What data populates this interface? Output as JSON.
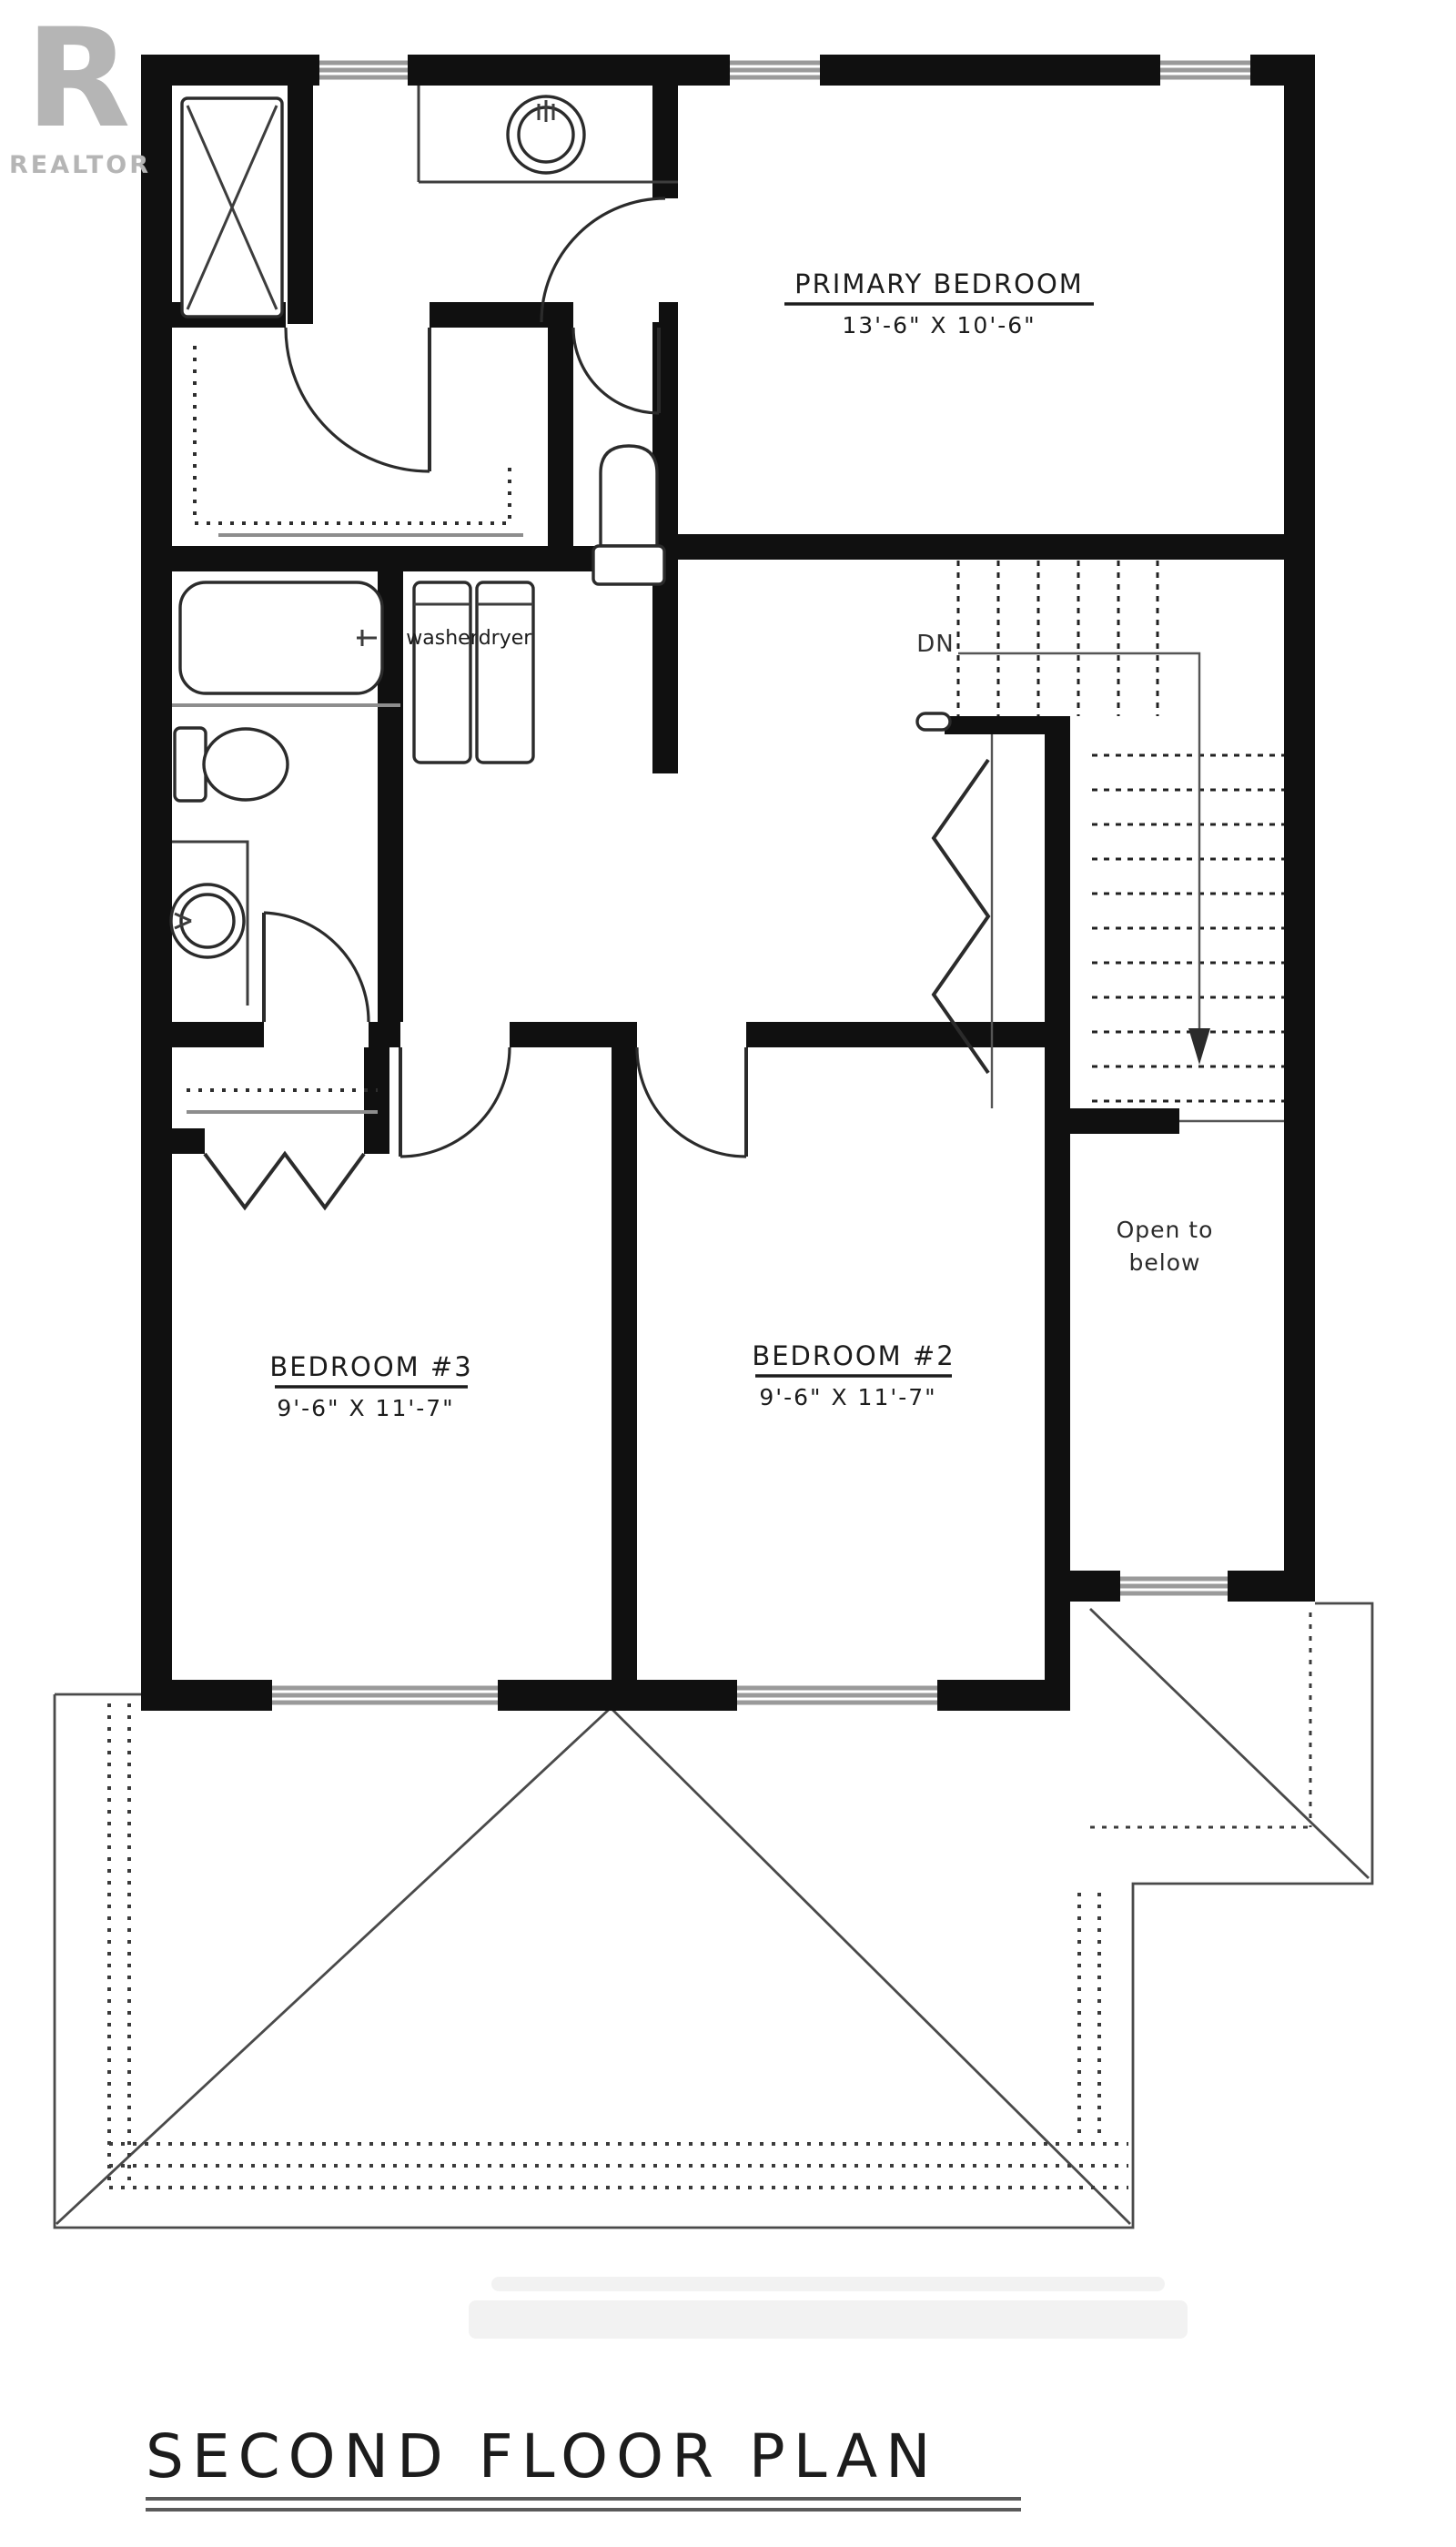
{
  "logo": {
    "letter": "R",
    "label": "REALTOR"
  },
  "title": "SECOND FLOOR PLAN",
  "rooms": {
    "primary": {
      "name": "PRIMARY BEDROOM",
      "dims": "13'-6\" X 10'-6\""
    },
    "bedroom3": {
      "name": "BEDROOM #3",
      "dims": "9'-6\" X 11'-7\""
    },
    "bedroom2": {
      "name": "BEDROOM #2",
      "dims": "9'-6\" X 11'-7\""
    },
    "open_below": {
      "line1": "Open to",
      "line2": "below"
    }
  },
  "laundry": {
    "washer": "washer",
    "dryer": "dryer"
  },
  "stairs": {
    "down_label": "DN"
  },
  "colors": {
    "wall": "#101010",
    "thin_line": "#3d3d3d",
    "gray_line": "#8d8d8d",
    "logo_gray": "#b5b5b5"
  }
}
